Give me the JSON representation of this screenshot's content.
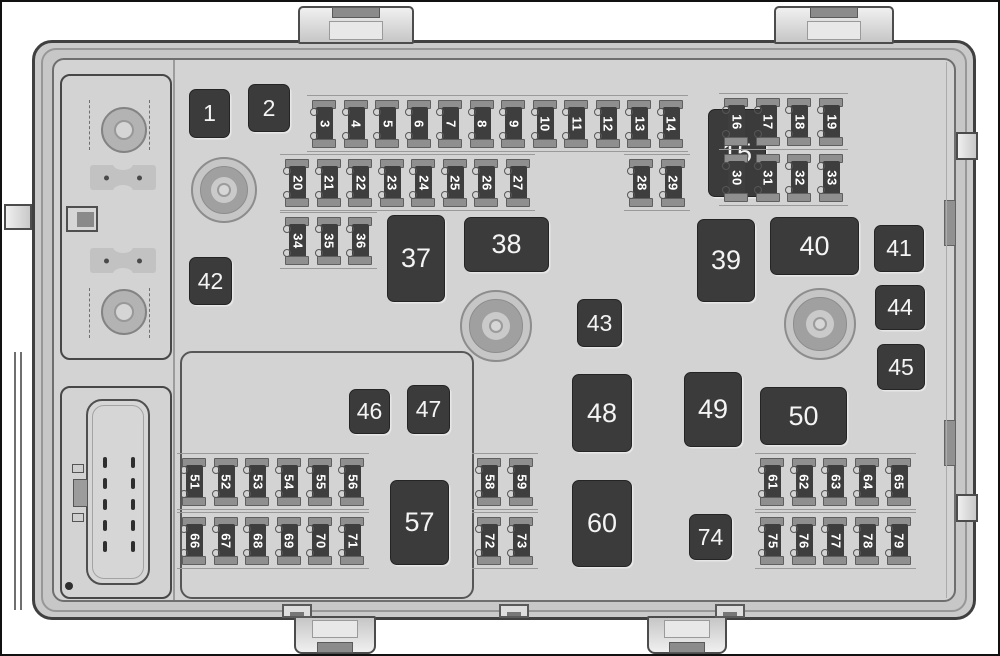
{
  "figure_title": "Engine compartment fuse block diagram",
  "colors": {
    "relay_fill": "#3b3b3b",
    "relay_text": "#f4f4f4",
    "fuse_body": "#3e3e3e",
    "fuse_terminal": "#8f8f8f",
    "panel": "#d3d3d3",
    "case": "#cacaca",
    "outline": "#404040"
  },
  "fusebox": {
    "relays": [
      {
        "label": "1",
        "x": 187,
        "y": 87,
        "w": 41,
        "h": 49
      },
      {
        "label": "2",
        "x": 246,
        "y": 82,
        "w": 42,
        "h": 48
      },
      {
        "label": "15",
        "x": 706,
        "y": 107,
        "w": 58,
        "h": 88
      },
      {
        "label": "37",
        "x": 385,
        "y": 213,
        "w": 58,
        "h": 87
      },
      {
        "label": "38",
        "x": 462,
        "y": 215,
        "w": 85,
        "h": 55
      },
      {
        "label": "39",
        "x": 695,
        "y": 217,
        "w": 58,
        "h": 83
      },
      {
        "label": "40",
        "x": 768,
        "y": 215,
        "w": 89,
        "h": 58
      },
      {
        "label": "41",
        "x": 872,
        "y": 223,
        "w": 50,
        "h": 47
      },
      {
        "label": "42",
        "x": 187,
        "y": 255,
        "w": 43,
        "h": 48
      },
      {
        "label": "43",
        "x": 575,
        "y": 297,
        "w": 45,
        "h": 48
      },
      {
        "label": "44",
        "x": 873,
        "y": 283,
        "w": 50,
        "h": 45
      },
      {
        "label": "45",
        "x": 875,
        "y": 342,
        "w": 48,
        "h": 46
      },
      {
        "label": "46",
        "x": 347,
        "y": 387,
        "w": 41,
        "h": 45
      },
      {
        "label": "47",
        "x": 405,
        "y": 383,
        "w": 43,
        "h": 49
      },
      {
        "label": "48",
        "x": 570,
        "y": 372,
        "w": 60,
        "h": 78
      },
      {
        "label": "49",
        "x": 682,
        "y": 370,
        "w": 58,
        "h": 75
      },
      {
        "label": "50",
        "x": 758,
        "y": 385,
        "w": 87,
        "h": 58
      },
      {
        "label": "57",
        "x": 388,
        "y": 478,
        "w": 59,
        "h": 85
      },
      {
        "label": "60",
        "x": 570,
        "y": 478,
        "w": 60,
        "h": 87
      },
      {
        "label": "74",
        "x": 687,
        "y": 512,
        "w": 43,
        "h": 46
      }
    ],
    "fuse_groups": [
      {
        "x": 310,
        "y": 98,
        "step": 31.5,
        "labels": [
          "3",
          "4",
          "5",
          "6",
          "7",
          "8",
          "9",
          "10",
          "11",
          "12",
          "13",
          "14"
        ]
      },
      {
        "x": 722,
        "y": 96,
        "step": 31.7,
        "labels": [
          "16",
          "17",
          "18",
          "19"
        ]
      },
      {
        "x": 283,
        "y": 157,
        "step": 31.5,
        "labels": [
          "20",
          "21",
          "22",
          "23",
          "24",
          "25",
          "26",
          "27"
        ]
      },
      {
        "x": 627,
        "y": 157,
        "step": 31.5,
        "labels": [
          "28",
          "29"
        ]
      },
      {
        "x": 722,
        "y": 152,
        "step": 31.7,
        "labels": [
          "30",
          "31",
          "32",
          "33"
        ]
      },
      {
        "x": 283,
        "y": 215,
        "step": 31.5,
        "labels": [
          "34",
          "35",
          "36"
        ]
      },
      {
        "x": 180,
        "y": 456,
        "step": 31.6,
        "labels": [
          "51",
          "52",
          "53",
          "54",
          "55",
          "56"
        ]
      },
      {
        "x": 475,
        "y": 456,
        "step": 32,
        "labels": [
          "58",
          "59"
        ]
      },
      {
        "x": 758,
        "y": 456,
        "step": 31.7,
        "labels": [
          "61",
          "62",
          "63",
          "64",
          "65"
        ]
      },
      {
        "x": 180,
        "y": 515,
        "step": 31.6,
        "labels": [
          "66",
          "67",
          "68",
          "69",
          "70",
          "71"
        ]
      },
      {
        "x": 475,
        "y": 515,
        "step": 32,
        "labels": [
          "72",
          "73"
        ]
      },
      {
        "x": 758,
        "y": 515,
        "step": 31.7,
        "labels": [
          "75",
          "76",
          "77",
          "78",
          "79"
        ]
      }
    ],
    "bolts": [
      {
        "cx": 222,
        "cy": 188,
        "r": 33
      },
      {
        "cx": 494,
        "cy": 324,
        "r": 36
      },
      {
        "cx": 818,
        "cy": 322,
        "r": 36
      }
    ]
  }
}
